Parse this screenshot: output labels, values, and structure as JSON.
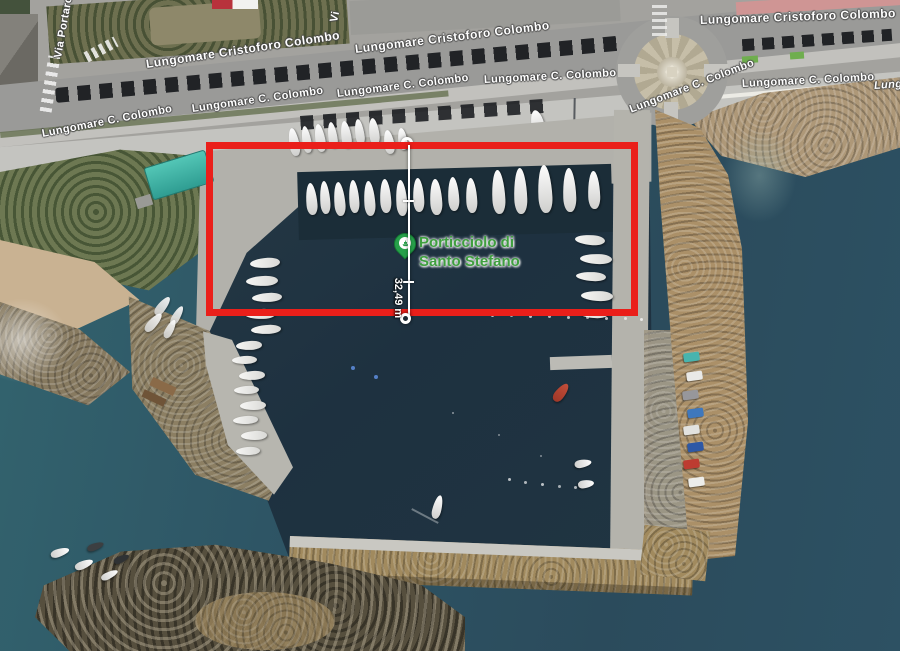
{
  "poi": {
    "line1": "Porticciolo di",
    "line2": "Santo Stefano",
    "label_color": "#3f9f3f",
    "marker_icon": "harbor-pin-icon",
    "pin_color": "#27a04a"
  },
  "measurement": {
    "label": "32,49 m"
  },
  "annotation": {
    "type": "rectangle",
    "color": "#ea1f1a"
  },
  "roads": {
    "labels": [
      {
        "text": "Via Portaro"
      },
      {
        "text": "Lungomare Cristoforo Colombo"
      },
      {
        "text": "Lungomare Cristoforo Colombo"
      },
      {
        "text": "Lungomare Cristoforo Colombo"
      },
      {
        "text": "Lungomare C. Colombo"
      },
      {
        "text": "Lungomare C. Colombo"
      },
      {
        "text": "Lungomare C. Colombo"
      },
      {
        "text": "Lungomare C. Colombo"
      },
      {
        "text": "Lungomare C. Colombo"
      },
      {
        "text": "Lungomare C. Colombo"
      },
      {
        "text": "Lungo"
      },
      {
        "text": "Vi"
      }
    ]
  }
}
